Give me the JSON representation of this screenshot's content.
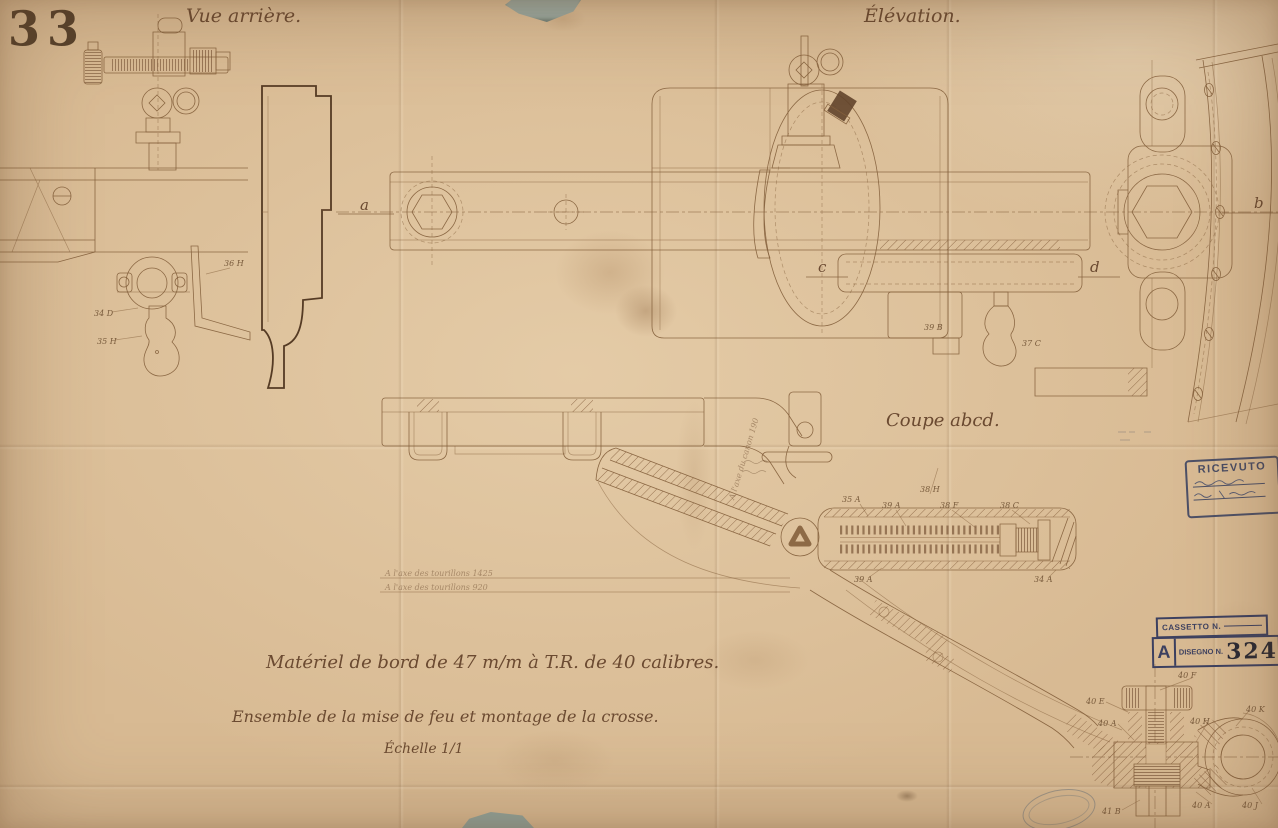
{
  "document": {
    "plate_number": "33",
    "view_labels": {
      "rear": "Vue arrière.",
      "elevation": "Élévation.",
      "section": "Coupe abcd."
    },
    "title": {
      "line1": "Matériel de bord de 47 m/m à T.R. de 40 calibres.",
      "line2": "Ensemble de la mise de feu et montage de la crosse.",
      "scale": "Échelle 1/1"
    },
    "section_letters": {
      "a": "a",
      "b": "b",
      "c": "c",
      "d": "d"
    },
    "notes": {
      "axis1": "A l'axe des tourillons   1425",
      "axis2": "A l'axe des tourillons   920",
      "rotated": "A l'axe du canon  190"
    },
    "part_labels": [
      "36 H",
      "34 D",
      "35 H",
      "39 B",
      "37 C",
      "35 A",
      "39 A",
      "38 F",
      "38 C",
      "38 H",
      "39 A",
      "34 A",
      "40 F",
      "40 E",
      "40 A",
      "40 H",
      "40 K",
      "41 B",
      "40 A",
      "40 J"
    ]
  },
  "stamps": {
    "ricevuto_title": "RICEVUTO",
    "cassetto_label": "CASSETTO N.",
    "disegno_letter": "A",
    "disegno_label": "DISEGNO N.",
    "disegno_number": "324"
  },
  "colors": {
    "paper": "#d8ba93",
    "ink": "#85613d",
    "dark_ink": "#553b24",
    "handwriting": "#6b4a31",
    "stamp_blue": "#3c4060",
    "number_dark": "#282833",
    "backing_tear": "#9aa9a1"
  }
}
